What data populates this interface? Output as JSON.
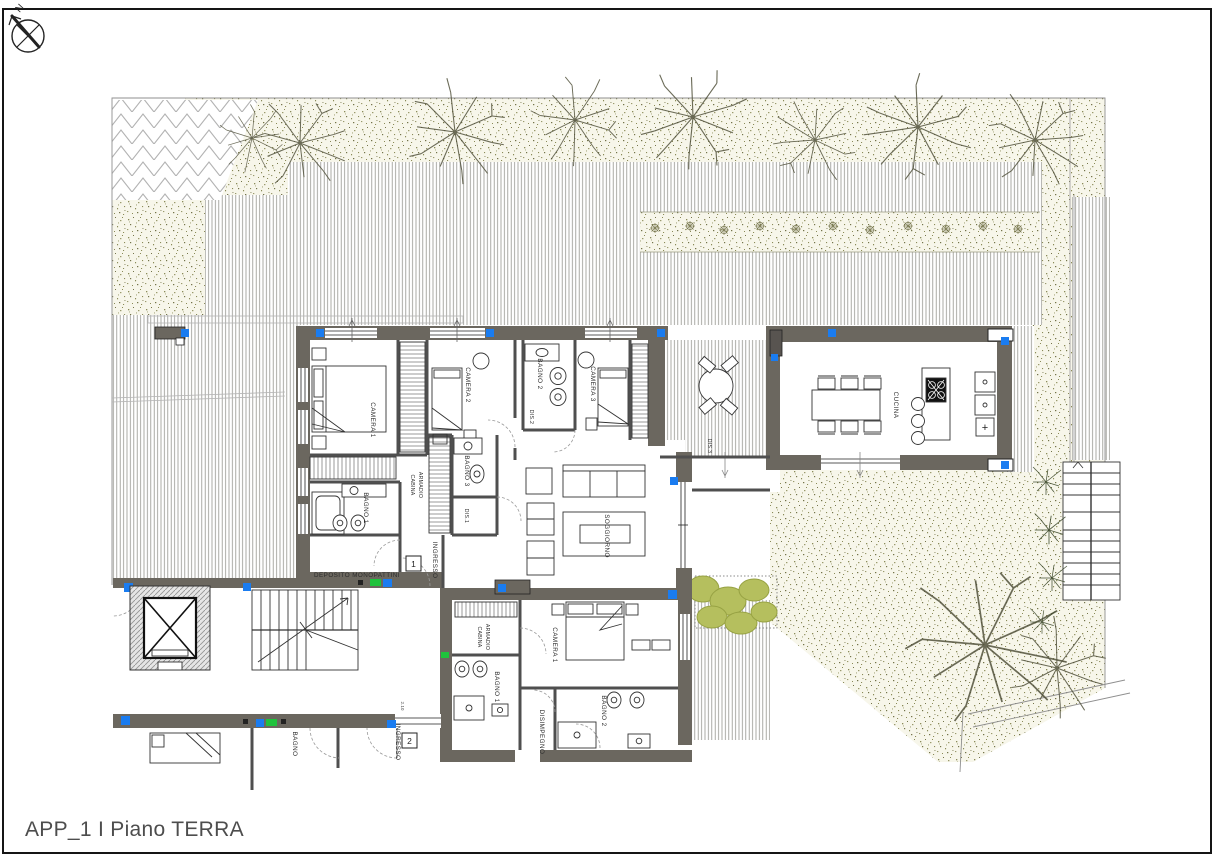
{
  "page": {
    "title": "APP_1 I Piano TERRA"
  },
  "compass": {
    "north_label": "N"
  },
  "colors": {
    "wall": "#6b675f",
    "partition": "#4f4f4f",
    "furniture_line": "#333333",
    "deck_hatch": "#8e8e88",
    "gravel_bg": "#f7f6ea",
    "gravel_dot": "#8b8b58",
    "marker_blue": "#1a7cf0",
    "marker_green": "#1fc23c",
    "hedge_green": "#b5bf5e",
    "title_text": "#4d4d4d"
  },
  "plan": {
    "unit1": {
      "camera1": "CAMERA 1",
      "camera2": "CAMERA 2",
      "camera3": "CAMERA 3",
      "bagno1": "BAGNO 1",
      "bagno2": "BAGNO 2",
      "bagno3": "BAGNO 3",
      "dis1": "DIS.1",
      "dis2": "DIS.2",
      "dis3": "DIS.3",
      "cabina_line1": "CABINA",
      "cabina_line2": "ARMADIO",
      "ingresso": "INGRESSO",
      "entry_number": "1",
      "deposito": "DEPOSITO MONOPATTINI",
      "soggiorno": "SOGGIORNO",
      "cucina": "CUCINA",
      "kitchen_plus": "+"
    },
    "unit2": {
      "cabina_line1": "CABINA",
      "cabina_line2": "ARMADIO",
      "camera1": "CAMERA 1",
      "bagno1": "BAGNO 1",
      "bagno2": "BAGNO 2",
      "disimpegno": "DISIMPEGNO",
      "ingresso": "INGRESSO",
      "entry_number": "2",
      "bagno": "BAGNO",
      "door_dim": "2.10"
    }
  }
}
